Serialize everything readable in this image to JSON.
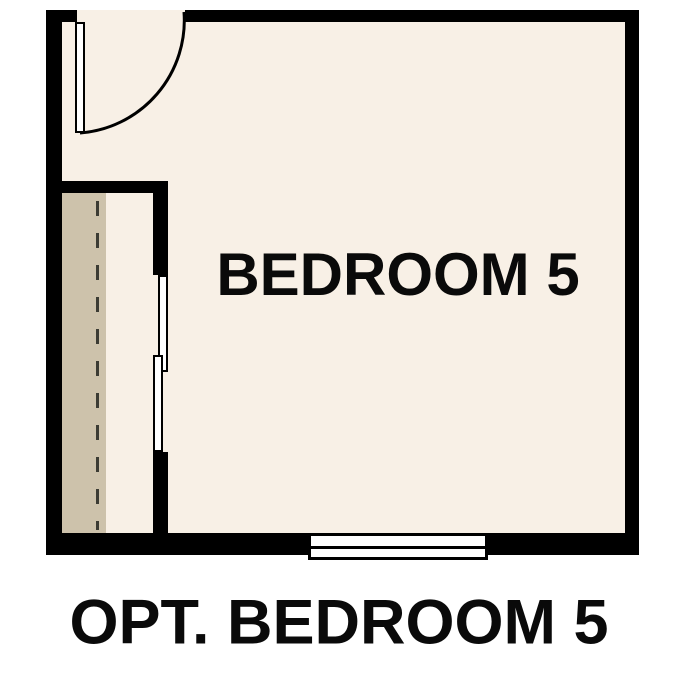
{
  "labels": {
    "room": "BEDROOM 5",
    "caption": "OPT. BEDROOM 5"
  },
  "colors": {
    "background": "#ffffff",
    "wall": "#000000",
    "floor": "#f8f0e6",
    "closet-floor": "#cdc2ab",
    "fixture": "#ffffff",
    "dash": "#3c3c34",
    "text": "#0a0a0a"
  },
  "plan": {
    "type": "floor-plan",
    "room": "BEDROOM 5",
    "visible_elements": [
      "hinged door with quarter-circle swing arc at top-left",
      "closet along left wall with dashed rod line",
      "bypass sliding closet doors",
      "window centered in bottom wall"
    ]
  }
}
